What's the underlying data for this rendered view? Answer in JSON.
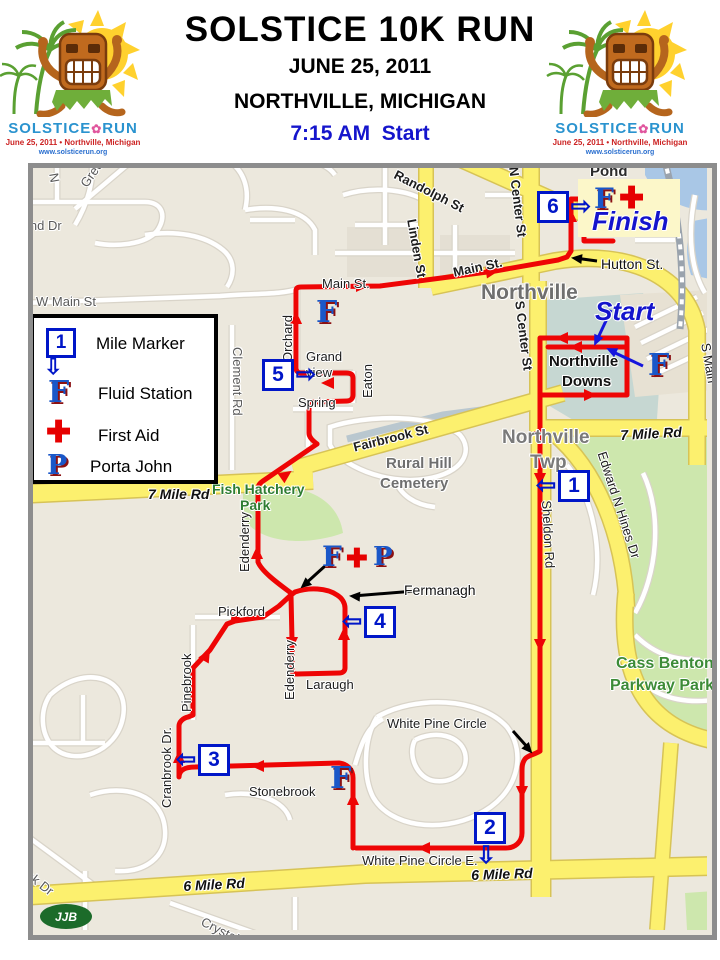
{
  "header": {
    "title": "SOLSTICE 10K RUN",
    "date": "JUNE 25, 2011",
    "location": "NORTHVILLE, MICHIGAN",
    "start_time": "7:15 AM  Start"
  },
  "logo": {
    "word1": "SOLSTICE",
    "dot": "✿",
    "word2": "RUN",
    "tagline": "June 25, 2011 • Northville, Michigan",
    "url": "www.solsticerun.org"
  },
  "legend": {
    "items": [
      {
        "label": "Mile Marker"
      },
      {
        "label": "Fluid Station"
      },
      {
        "label": "First Aid"
      },
      {
        "label": "Porta John"
      }
    ],
    "mile_number": "1"
  },
  "map": {
    "attribution": "JJB",
    "colors": {
      "route": "#ee0505",
      "road_yellow": "#fcf06e",
      "park_green": "#cde7ad",
      "water_blue": "#a9c7e6",
      "marker_blue": "#0016c8"
    },
    "labels": [
      {
        "t": "Pond",
        "x": 590,
        "y": 164,
        "c": "place"
      },
      {
        "t": "Hutton St.",
        "x": 601,
        "y": 257,
        "c": "street14"
      },
      {
        "t": "Northville",
        "x": 481,
        "y": 282,
        "c": "town"
      },
      {
        "t": "Main St.",
        "x": 322,
        "y": 277,
        "c": "street"
      },
      {
        "t": "Main St.",
        "x": 452,
        "y": 266,
        "c": "street-b",
        "r": -12
      },
      {
        "t": "Randolph St",
        "x": 398,
        "y": 168,
        "c": "street-b",
        "r": 27
      },
      {
        "t": "Linden St",
        "x": 418,
        "y": 218,
        "c": "street-b",
        "r": 80
      },
      {
        "t": "N Center St",
        "x": 520,
        "y": 166,
        "c": "street-b",
        "r": 83
      },
      {
        "t": "S Center St",
        "x": 526,
        "y": 300,
        "c": "street-b",
        "r": 83
      },
      {
        "t": "W Main St",
        "x": 36,
        "y": 295,
        "c": "street-g"
      },
      {
        "t": "Bend Dr",
        "x": 14,
        "y": 219,
        "c": "street-g"
      },
      {
        "t": "Green",
        "x": 78,
        "y": 182,
        "c": "street-g",
        "r": -55
      },
      {
        "t": "N",
        "x": 60,
        "y": 172,
        "c": "street-g",
        "r": 80
      },
      {
        "t": "Orchard",
        "x": 281,
        "y": 362,
        "c": "street",
        "r": -90
      },
      {
        "t": "Grand",
        "x": 306,
        "y": 350,
        "c": "street"
      },
      {
        "t": "view",
        "x": 306,
        "y": 366,
        "c": "street"
      },
      {
        "t": "Eaton",
        "x": 361,
        "y": 398,
        "c": "street",
        "r": -90
      },
      {
        "t": "Spring",
        "x": 298,
        "y": 396,
        "c": "street"
      },
      {
        "t": "Clement Rd",
        "x": 244,
        "y": 347,
        "c": "street-g",
        "r": 90
      },
      {
        "t": "Fairbrook St",
        "x": 352,
        "y": 441,
        "c": "street-b",
        "r": -14
      },
      {
        "t": "7 Mile Rd",
        "x": 148,
        "y": 487,
        "c": "mile-rd"
      },
      {
        "t": "7 Mile Rd",
        "x": 620,
        "y": 428,
        "c": "mile-rd",
        "r": -3
      },
      {
        "t": "Northville",
        "x": 502,
        "y": 428,
        "c": "town2"
      },
      {
        "t": "Twp",
        "x": 530,
        "y": 453,
        "c": "town2"
      },
      {
        "t": "Rural Hill",
        "x": 386,
        "y": 456,
        "c": "town2s"
      },
      {
        "t": "Cemetery",
        "x": 380,
        "y": 476,
        "c": "town2s"
      },
      {
        "t": "Fish Hatchery",
        "x": 212,
        "y": 482,
        "c": "park"
      },
      {
        "t": "Park",
        "x": 240,
        "y": 498,
        "c": "park"
      },
      {
        "t": "Edenderry",
        "x": 238,
        "y": 572,
        "c": "street",
        "r": -90
      },
      {
        "t": "Edenderry",
        "x": 283,
        "y": 700,
        "c": "street",
        "r": -90
      },
      {
        "t": "Pickford",
        "x": 218,
        "y": 605,
        "c": "street"
      },
      {
        "t": "Pinebrook",
        "x": 180,
        "y": 712,
        "c": "street",
        "r": -90
      },
      {
        "t": "Cranbrook Dr.",
        "x": 160,
        "y": 808,
        "c": "street",
        "r": -90
      },
      {
        "t": "Laraugh",
        "x": 306,
        "y": 678,
        "c": "street"
      },
      {
        "t": "Fermanagh",
        "x": 404,
        "y": 583,
        "c": "street14"
      },
      {
        "t": "White Pine Circle",
        "x": 387,
        "y": 717,
        "c": "street"
      },
      {
        "t": "Stonebrook",
        "x": 249,
        "y": 785,
        "c": "street"
      },
      {
        "t": "White Pine Circle E.",
        "x": 362,
        "y": 854,
        "c": "street"
      },
      {
        "t": "6 Mile Rd",
        "x": 183,
        "y": 879,
        "c": "mile-rd",
        "r": -3
      },
      {
        "t": "6 Mile Rd",
        "x": 471,
        "y": 868,
        "c": "mile-rd",
        "r": -2
      },
      {
        "t": "Crystal",
        "x": 205,
        "y": 915,
        "c": "street-g",
        "r": 27
      },
      {
        "t": "Red Oak Dr",
        "x": 2,
        "y": 845,
        "c": "street-g",
        "r": 38
      },
      {
        "t": "Northville",
        "x": 549,
        "y": 354,
        "c": "downs"
      },
      {
        "t": "Downs",
        "x": 562,
        "y": 374,
        "c": "downs"
      },
      {
        "t": "Cass Benton",
        "x": 616,
        "y": 656,
        "c": "park16"
      },
      {
        "t": "Parkway Park",
        "x": 610,
        "y": 678,
        "c": "park16"
      },
      {
        "t": "Sheldon Rd",
        "x": 553,
        "y": 500,
        "c": "street",
        "r": 87
      },
      {
        "t": "Edward N Hines Dr",
        "x": 608,
        "y": 450,
        "c": "street",
        "r": 72
      },
      {
        "t": "S Main",
        "x": 712,
        "y": 342,
        "c": "street",
        "r": 80
      },
      {
        "t": "Start",
        "x": 595,
        "y": 298,
        "c": "startfinish"
      },
      {
        "t": "Finish",
        "x": 592,
        "y": 208,
        "c": "startfinish"
      }
    ],
    "mile_markers": [
      {
        "n": "1",
        "x": 558,
        "y": 470,
        "dir": "left"
      },
      {
        "n": "2",
        "x": 474,
        "y": 812,
        "dir": "down"
      },
      {
        "n": "3",
        "x": 198,
        "y": 744,
        "dir": "left"
      },
      {
        "n": "4",
        "x": 364,
        "y": 606,
        "dir": "left"
      },
      {
        "n": "5",
        "x": 262,
        "y": 359,
        "dir": "right"
      },
      {
        "n": "6",
        "x": 537,
        "y": 191,
        "dir": "right"
      }
    ],
    "stations": [
      {
        "type": "F",
        "x": 316,
        "y": 298,
        "size": 30
      },
      {
        "type": "F",
        "x": 648,
        "y": 351,
        "size": 30
      },
      {
        "type": "F",
        "x": 330,
        "y": 764,
        "size": 30
      },
      {
        "type": "F",
        "x": 594,
        "y": 185,
        "size": 28
      },
      {
        "type": "cross",
        "x": 619,
        "y": 184,
        "size": 30
      },
      {
        "type": "F",
        "x": 322,
        "y": 543,
        "size": 28
      },
      {
        "type": "cross",
        "x": 346,
        "y": 545,
        "size": 26
      },
      {
        "type": "P",
        "x": 373,
        "y": 544,
        "size": 26
      }
    ]
  }
}
